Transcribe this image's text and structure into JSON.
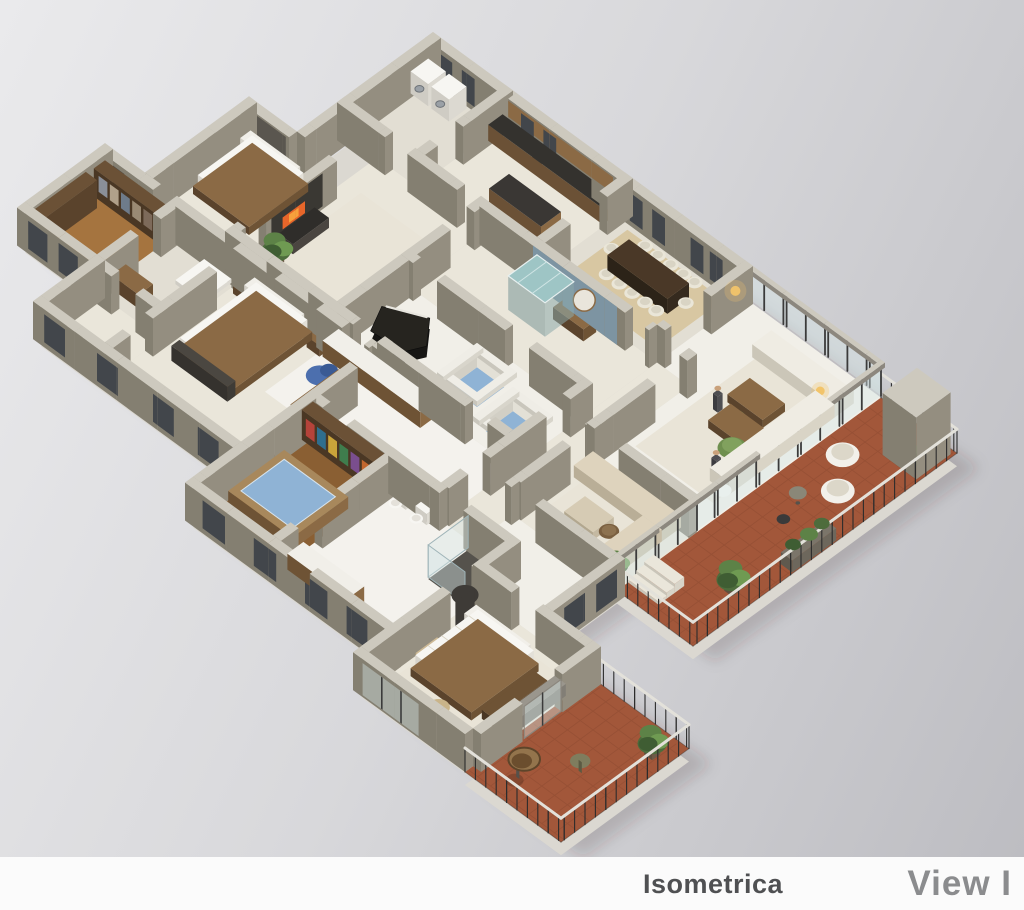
{
  "page": {
    "title": "Isometric apartment floor plan render",
    "width": 1024,
    "height": 910
  },
  "footer": {
    "brand": "Isometrica",
    "view_label": "View I"
  },
  "colors": {
    "bg_top": "#eaeaec",
    "bg_mid": "#d8d8db",
    "bg_bottom": "#bcbcc1",
    "footer_bg": "#fbfbfb",
    "brand_text": "#4f5052",
    "view_text": "#8b8c8e",
    "wall_top": "#cdc9be",
    "wall_u": "#948e80",
    "wall_v": "#847f71",
    "wall_dark": "#5a564f",
    "accent_blue": "#7d94a2",
    "slab": "#dbd8d1",
    "floor_cream": "#eae6da",
    "floor_tile": "#e2ded3",
    "floor_white": "#f1efe8",
    "marble": "#f4f2ed",
    "wood": "#a5743f",
    "wood_dark_floor": "#8a5f33",
    "terracotta": "#a2573a",
    "terracotta_dark": "#8a4930",
    "rug_tan": "#d8c7a2",
    "rug_light": "#e9e4d7",
    "glass": "rgba(215,230,232,0.42)",
    "mullion": "#3b3b3b",
    "beam": "#8c877e",
    "water": "#8fb3d5",
    "teal": "#9ec5c5",
    "sofa_white": "#efece3",
    "sofa_shade": "#d9d4c6",
    "sofa_beige": "#ded3bd",
    "beige_shade": "#c8bda6",
    "wood_mid": "#8b6a45",
    "wood_dk": "#6b5136",
    "black": "#262422",
    "dark_panel": "#3a3833",
    "fire": "#e8662a",
    "fire_core": "#f7a03c",
    "green": "#6f8f4f",
    "green_dk": "#4d6c3c",
    "lamp": "#f2c46a",
    "gray_sofa": "#9a968d",
    "blue_chair": "#4c6fae",
    "blue_chair_dk": "#3a5a94",
    "white": "#f7f6f2",
    "win": "#42464b",
    "person": "#4e4e52",
    "skin": "#c9a17b",
    "shadow": "rgba(55,52,48,0.18)",
    "books": [
      "#b5433a",
      "#2f6e8e",
      "#c9a43a",
      "#3f7d4d",
      "#7a4e8e",
      "#c2672f"
    ]
  }
}
